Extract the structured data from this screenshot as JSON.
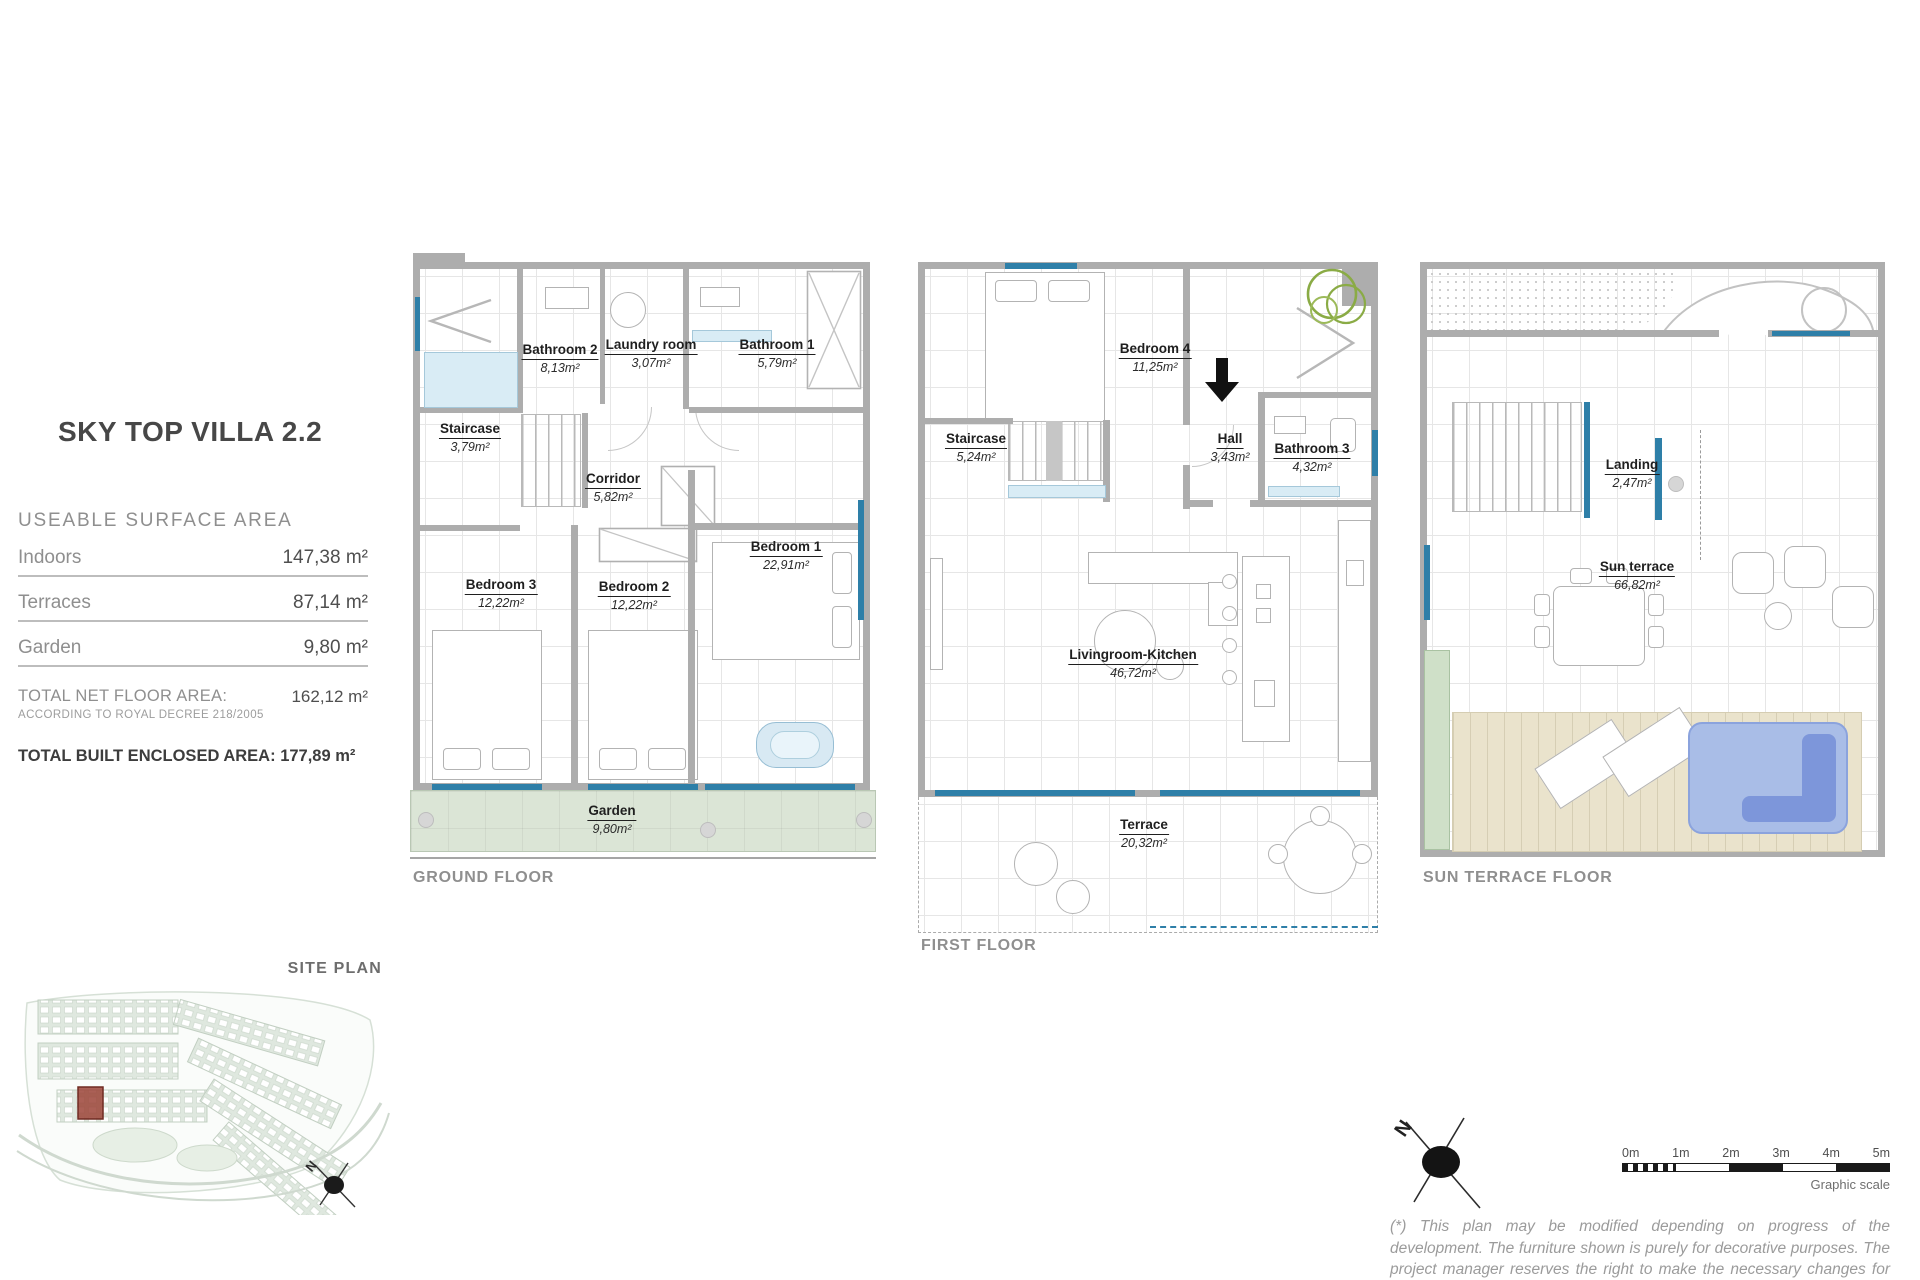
{
  "panel": {
    "title": "SKY TOP VILLA 2.2",
    "section": "USEABLE SURFACE AREA",
    "rows": [
      {
        "label": "Indoors",
        "value": "147,38 m²"
      },
      {
        "label": "Terraces",
        "value": "87,14 m²"
      },
      {
        "label": "Garden",
        "value": "9,80 m²"
      }
    ],
    "total_net_label": "TOTAL NET FLOOR AREA:",
    "total_net_value": "162,12  m²",
    "total_net_note": "ACCORDING TO ROYAL DECREE 218/2005",
    "total_built_label": "TOTAL BUILT ENCLOSED AREA:",
    "total_built_value": "177,89 m²"
  },
  "ground_floor": {
    "caption": "GROUND FLOOR",
    "rooms": {
      "bathroom2": {
        "name": "Bathroom 2",
        "area": "8,13m²"
      },
      "laundry": {
        "name": "Laundry room",
        "area": "3,07m²"
      },
      "bathroom1": {
        "name": "Bathroom 1",
        "area": "5,79m²"
      },
      "staircase": {
        "name": "Staircase",
        "area": "3,79m²"
      },
      "corridor": {
        "name": "Corridor",
        "area": "5,82m²"
      },
      "bedroom3": {
        "name": "Bedroom 3",
        "area": "12,22m²"
      },
      "bedroom2": {
        "name": "Bedroom 2",
        "area": "12,22m²"
      },
      "bedroom1": {
        "name": "Bedroom 1",
        "area": "22,91m²"
      },
      "garden": {
        "name": "Garden",
        "area": "9,80m²"
      }
    }
  },
  "first_floor": {
    "caption": "FIRST FLOOR",
    "rooms": {
      "bedroom4": {
        "name": "Bedroom 4",
        "area": "11,25m²"
      },
      "staircase": {
        "name": "Staircase",
        "area": "5,24m²"
      },
      "hall": {
        "name": "Hall",
        "area": "3,43m²"
      },
      "bathroom3": {
        "name": "Bathroom 3",
        "area": "4,32m²"
      },
      "living": {
        "name": "Livingroom-Kitchen",
        "area": "46,72m²"
      },
      "terrace": {
        "name": "Terrace",
        "area": "20,32m²"
      }
    }
  },
  "sun_terrace_floor": {
    "caption": "SUN TERRACE FLOOR",
    "rooms": {
      "landing": {
        "name": "Landing",
        "area": "2,47m²"
      },
      "sun_terrace": {
        "name": "Sun terrace",
        "area": "66,82m²"
      }
    }
  },
  "site_plan": {
    "label": "SITE PLAN",
    "north_letter": "N"
  },
  "compass": {
    "north_letter": "N"
  },
  "scale_bar": {
    "ticks": [
      "0m",
      "1m",
      "2m",
      "3m",
      "4m",
      "5m"
    ],
    "caption": "Graphic scale"
  },
  "disclaimer": "(*) This plan may be modified depending on progress of the development. The furniture shown is purely for decorative purposes. The project manager reserves the right to make the necessary changes for any possible functional, aesthetic and legal reasons, without this",
  "colors": {
    "wall": "#adadad",
    "glass_blue": "#2e7fa8",
    "garden_green": "#dbe5d6",
    "pool_blue": "#a9bde7",
    "deck_tan": "#eae3cc",
    "site_highlight_red": "#9c4438"
  }
}
